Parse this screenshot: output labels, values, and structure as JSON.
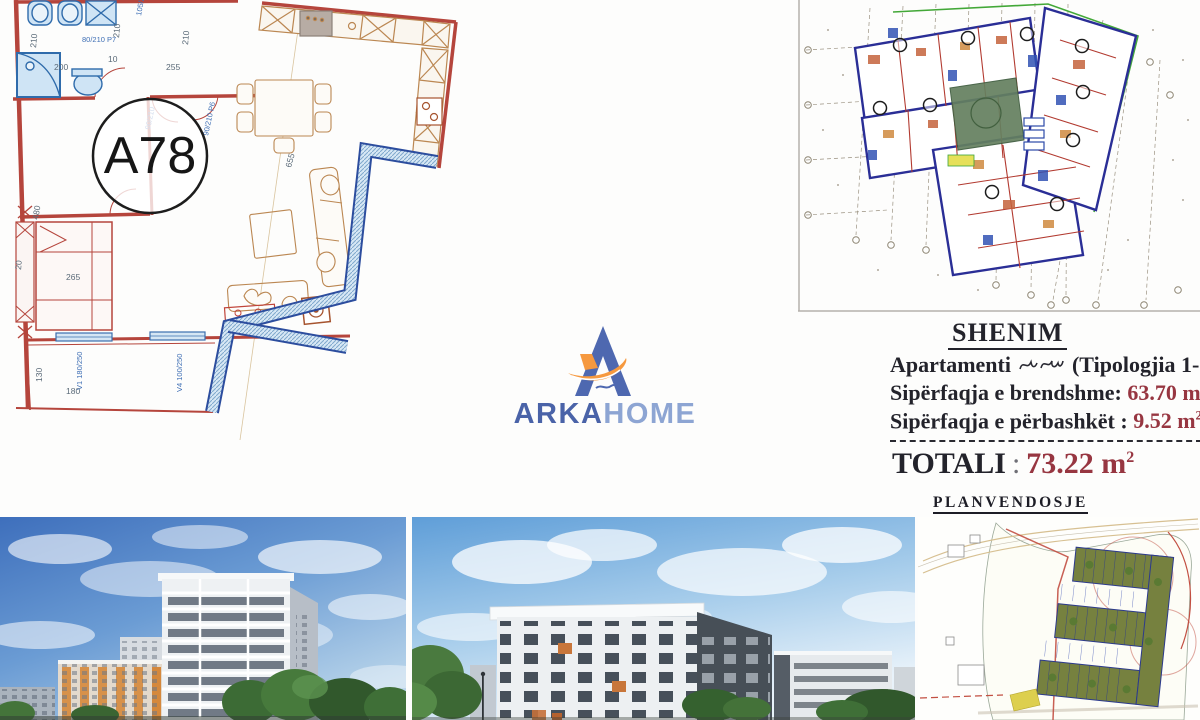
{
  "brand": {
    "wordmark_primary": "ARKA",
    "wordmark_secondary": "HOME"
  },
  "unit_plan": {
    "unit_label": "A78",
    "labels": {
      "dim_210_wall": "210",
      "dim_210_hall": "210",
      "dim_210_mid": "210",
      "dim_200": "200",
      "dim_10": "10",
      "door_p7": "80/210 P7",
      "dim_105_215": "105/215",
      "dim_255": "255",
      "door_90_210": "90/210",
      "door_p6": "90/210 P6",
      "dim_655": "655",
      "dim_265": "265",
      "dim_480": "480",
      "dim_20": "20",
      "dim_130": "130",
      "dim_180": "180",
      "win_v1": "V1 180/250",
      "win_v4": "V4 100/250"
    }
  },
  "shenim": {
    "title": "SHENIM",
    "line1_label": "Apartamenti",
    "line1_suffix": "(Tipologjia 1-",
    "line2_label": "Sipërfaqja e brendshme:",
    "line2_value": "63.70 m",
    "line3_label": "Sipërfaqja e përbashkët :",
    "line3_value": "9.52 m",
    "line3_sup": "2",
    "total_label": "TOTALI",
    "total_colon": ":",
    "total_value": "73.22 m",
    "total_sup": "2"
  },
  "site_plan": {
    "title": "PLANVENDOSJE"
  }
}
